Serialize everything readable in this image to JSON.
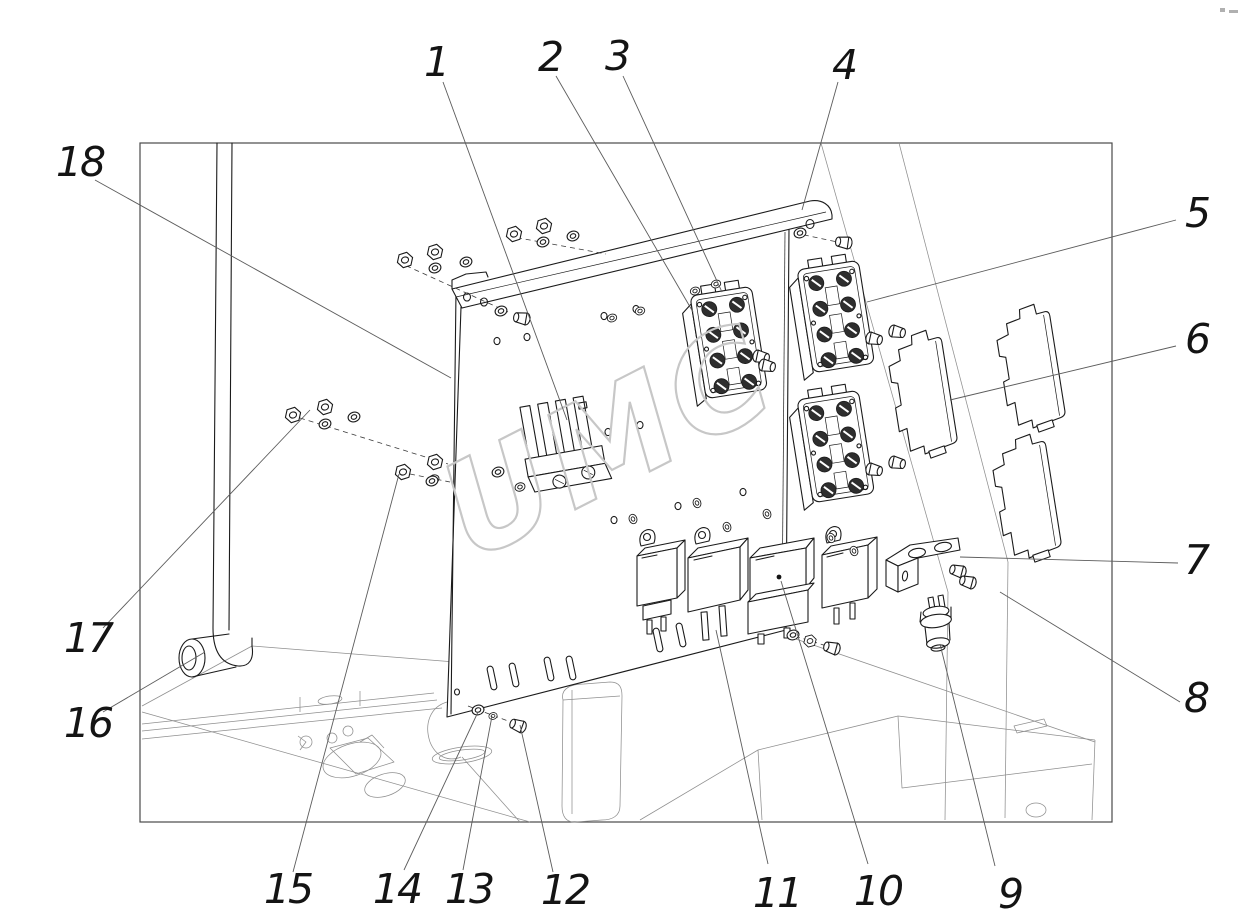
{
  "watermark": "UMC",
  "callouts": [
    {
      "label": "1"
    },
    {
      "label": "2"
    },
    {
      "label": "3"
    },
    {
      "label": "4"
    },
    {
      "label": "5"
    },
    {
      "label": "6"
    },
    {
      "label": "7"
    },
    {
      "label": "8"
    },
    {
      "label": "9"
    },
    {
      "label": "10"
    },
    {
      "label": "11"
    },
    {
      "label": "12"
    },
    {
      "label": "13"
    },
    {
      "label": "14"
    },
    {
      "label": "15"
    },
    {
      "label": "16"
    },
    {
      "label": "17"
    },
    {
      "label": "18"
    }
  ]
}
